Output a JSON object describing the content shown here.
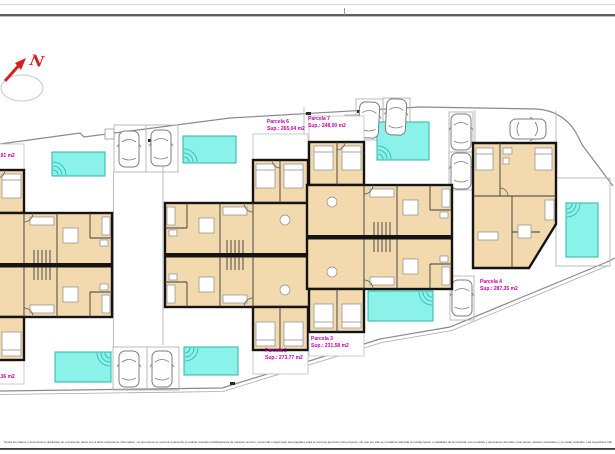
{
  "title": "Site plan with parcel floor plans",
  "compass": {
    "label": "N"
  },
  "parcels": [
    {
      "id": "parcela-1",
      "name": "Parcela 1",
      "area": "Sup.: 302,36 m2"
    },
    {
      "id": "parcela-2",
      "name": "Parcela 2",
      "area": "Sup.: 273,77 m2"
    },
    {
      "id": "parcela-3",
      "name": "Parcela 3",
      "area": "Sup.: 231,58 m2"
    },
    {
      "id": "parcela-4",
      "name": "Parcela 4",
      "area": "Sup.: 287,35 m2"
    },
    {
      "id": "parcela-5",
      "name": "Parcela 5",
      "area": "Sup.: 281,91 m2"
    },
    {
      "id": "parcela-6",
      "name": "Parcela 6",
      "area": "Sup.: 265,04 m2"
    },
    {
      "id": "parcela-7",
      "name": "Parcela 7",
      "area": "Sup.: 248,00 m2"
    }
  ],
  "colors": {
    "label_magenta": "#c400a4",
    "pool_fill": "#8bf2ea",
    "pool_border": "#2ab5ac",
    "wall_black": "#141414",
    "room_beige": "#f3d9ae",
    "compass_red": "#d42222",
    "boundary_gray": "#8a8a8a",
    "footer_blue": "#26306e"
  },
  "icons": {
    "north_arrow": "north-arrow-icon",
    "pool_steps": "pool-steps-arcs-icon",
    "car": "car-top-view-icon"
  },
  "footer": {
    "disclaimer": "Todos los planos y dimensiones ilustrados en el presente plano son a titulo meramente informativo. La promotora se reserva el derecho a realizar cuantas modificaciones de caracter tecnico, comercial o legal sean aconsejables para la correcta ejecucion del proyecto, sin que por ello se considere alterada la configuracion o calidades de la vivienda. Los muebles y decoracion del plano solo tienen caracter orientativo y no estan incluidos. Las superficies indicadas son aproximadas y expresadas en metros cuadrados. Plano de distribucion de Planta Baja y Primera. Documento sin validez contractual."
  }
}
